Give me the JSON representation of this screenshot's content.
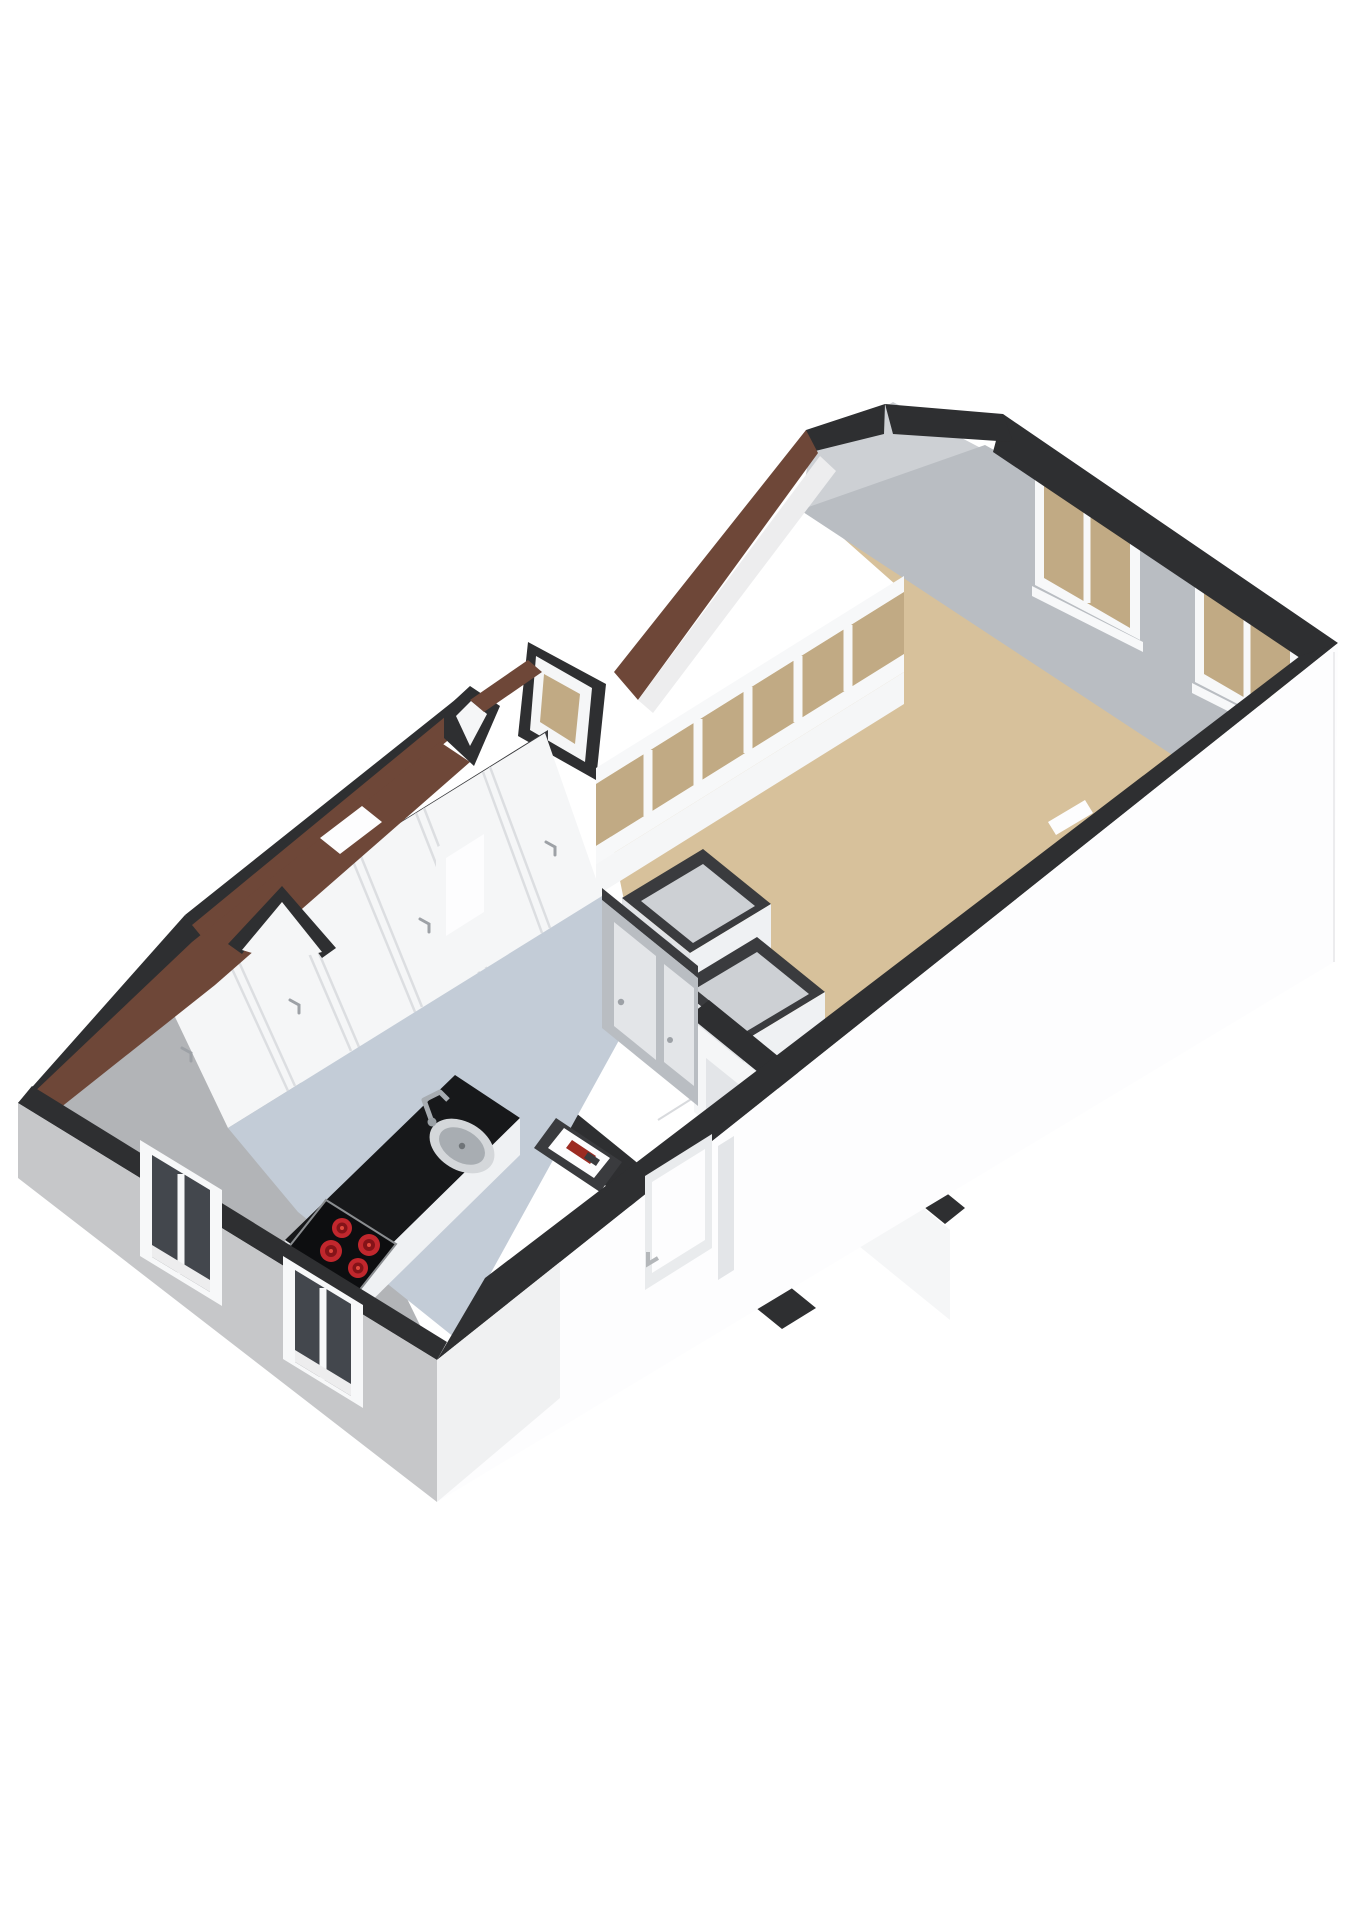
{
  "page": {
    "title": "3D floor plan cutaway render",
    "background": "#ffffff"
  },
  "palette": {
    "cap_dark": "#2e2f31",
    "cap_dark2": "#3a3b3e",
    "roof_brown": "#6e4738",
    "roof_brown_dark": "#53352b",
    "soffit": "#ededee",
    "wall_white": "#f5f6f7",
    "wall_white_bright": "#fdfdfe",
    "wall_gray": "#b9bdc2",
    "wall_gray_light": "#cdd0d4",
    "wall_gray_dark": "#a9acb0",
    "facade_sw": "#c6c7c9",
    "gable_sw": "#b2b4b7",
    "floor_tan": "#d7c19b",
    "floor_blue": "#c3ccd7",
    "glass_tan": "#c1aa84",
    "glass_dark": "#43474d",
    "frame_white": "#f7f8f9",
    "counter_black": "#17181a",
    "cabinet_white": "#eff1f3",
    "cabinet_shade": "#e2e4e7",
    "cooktop_black": "#0d0e10",
    "burner_red": "#c1272d",
    "burner_dark": "#841318",
    "burner_hot": "#e0483c",
    "sink_steel": "#d4d7da",
    "sink_inner": "#a8adb2",
    "handle_gray": "#9da1a6",
    "seam_gray": "#dcdee1",
    "hall_floor": "#eceef0",
    "door_panel": "#e3e5e8"
  },
  "scene": {
    "view": "isometric-3d-cutaway-floorplan",
    "rooms": [
      {
        "name": "living-room",
        "floor_color_key": "floor_tan",
        "far_wall_windows": 2,
        "window_glass": "tan-privacy"
      },
      {
        "name": "bay-window-strip",
        "window_band_panes": 6,
        "gable_window": 1
      },
      {
        "name": "kitchen",
        "floor_color_key": "floor_blue",
        "wardrobe_door_sections": 5,
        "interior_doors": 2
      },
      {
        "name": "storage-closets",
        "count": 2
      },
      {
        "name": "entry-hall",
        "floor_color_key": "hall_floor",
        "doors": 1
      }
    ],
    "fixtures": [
      {
        "name": "kitchen-counter",
        "color_key": "counter_black",
        "items": [
          "sink",
          "faucet",
          "cooktop"
        ]
      },
      {
        "name": "cooktop",
        "burners": 4,
        "burner_color_key": "burner_red"
      },
      {
        "name": "sink",
        "material_key": "sink_steel"
      },
      {
        "name": "radiator-niche",
        "accent": "red"
      },
      {
        "name": "entry-door",
        "location": "front-facade"
      }
    ],
    "exterior": {
      "front_facade_color_key": "wall_white_bright",
      "side_facade_color_key": "facade_sw",
      "side_facade_windows": 2,
      "roof_strips": "brown-tile",
      "wall_caps_color_key": "cap_dark",
      "dormer_gables": 3
    }
  }
}
